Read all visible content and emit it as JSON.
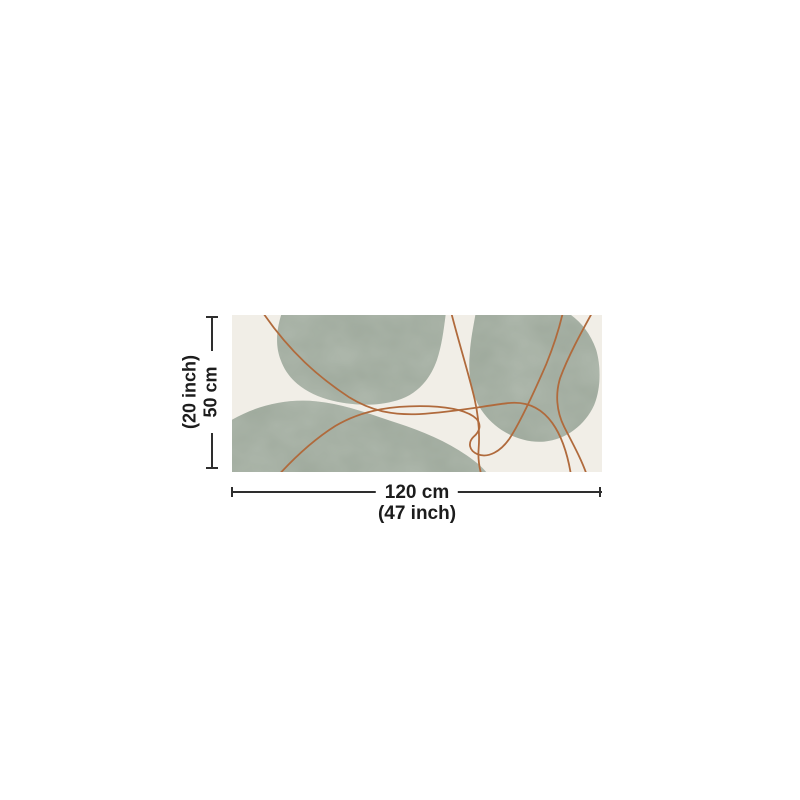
{
  "page": {
    "description": "Product size diagram of an abstract runner rug",
    "background_color": "#ffffff"
  },
  "artwork": {
    "name": "abstract-boho-rug-preview",
    "canvas_color": "#f1eee7",
    "blob_color": "#9ca79a",
    "stroke_color": "#b06a3c"
  },
  "dimension_annotations": {
    "line_color": "#2e2e2e",
    "text_color": "#1c1c1c",
    "height": {
      "line1": "(20 inch)",
      "line2": "50 cm"
    },
    "width": {
      "label": "120 cm",
      "sublabel": "(47 inch)"
    }
  }
}
